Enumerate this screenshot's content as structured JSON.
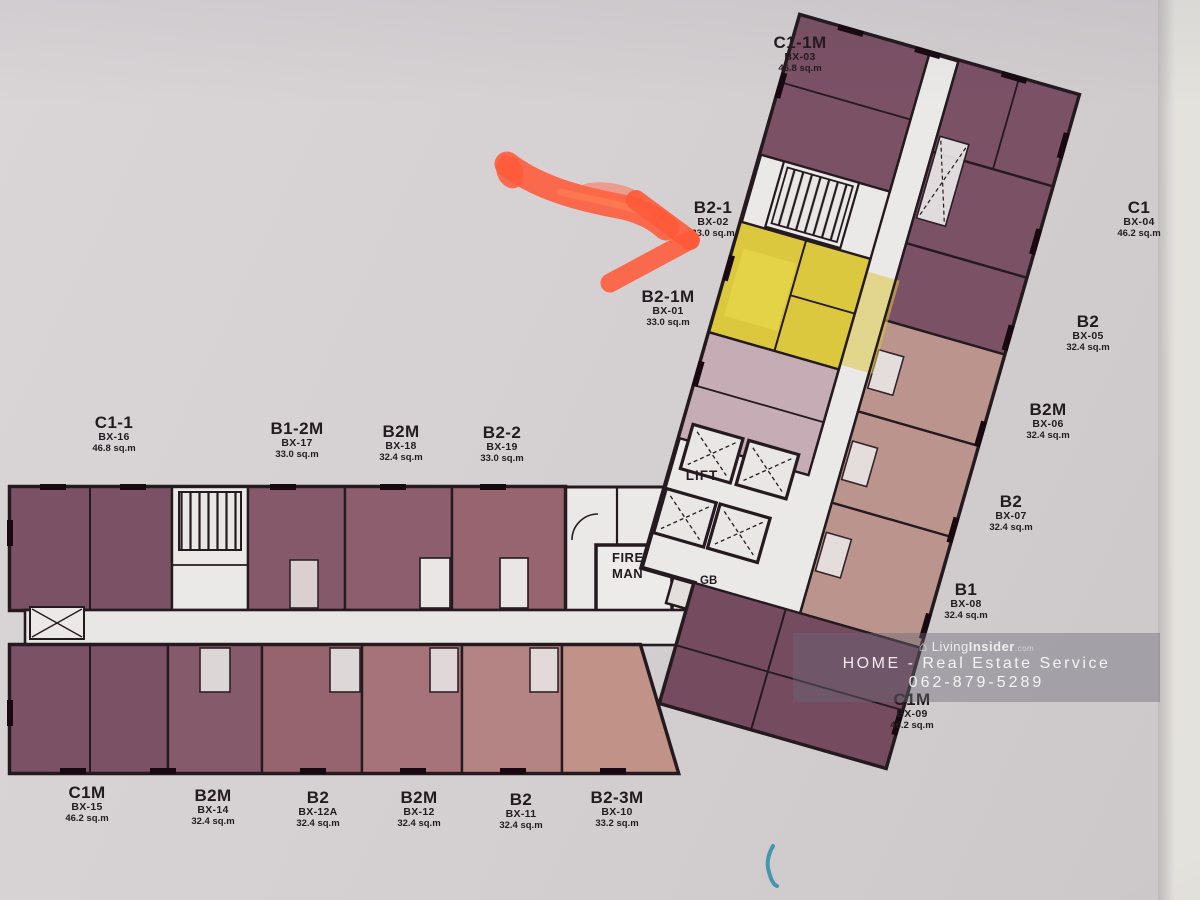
{
  "plan": {
    "units": [
      {
        "name": "C1-1M",
        "code": "BX-03",
        "area": "46.8 sq.m"
      },
      {
        "name": "B2-1",
        "code": "BX-02",
        "area": "33.0 sq.m"
      },
      {
        "name": "B2-1M",
        "code": "BX-01",
        "area": "33.0 sq.m"
      },
      {
        "name": "C1",
        "code": "BX-04",
        "area": "46.2 sq.m"
      },
      {
        "name": "B2",
        "code": "BX-05",
        "area": "32.4 sq.m"
      },
      {
        "name": "B2M",
        "code": "BX-06",
        "area": "32.4 sq.m"
      },
      {
        "name": "B2",
        "code": "BX-07",
        "area": "32.4 sq.m"
      },
      {
        "name": "B1",
        "code": "BX-08",
        "area": "32.4 sq.m"
      },
      {
        "name": "C1M",
        "code": "BX-09",
        "area": "46.2 sq.m"
      },
      {
        "name": "C1-1",
        "code": "BX-16",
        "area": "46.8 sq.m"
      },
      {
        "name": "B1-2M",
        "code": "BX-17",
        "area": "33.0 sq.m"
      },
      {
        "name": "B2M",
        "code": "BX-18",
        "area": "32.4 sq.m"
      },
      {
        "name": "B2-2",
        "code": "BX-19",
        "area": "33.0 sq.m"
      },
      {
        "name": "C1M",
        "code": "BX-15",
        "area": "46.2 sq.m"
      },
      {
        "name": "B2M",
        "code": "BX-14",
        "area": "32.4 sq.m"
      },
      {
        "name": "B2",
        "code": "BX-12A",
        "area": "32.4 sq.m"
      },
      {
        "name": "B2M",
        "code": "BX-12",
        "area": "32.4 sq.m"
      },
      {
        "name": "B2",
        "code": "BX-11",
        "area": "32.4 sq.m"
      },
      {
        "name": "B2-3M",
        "code": "BX-10",
        "area": "33.2 sq.m"
      }
    ],
    "core": {
      "lift": "LIFT",
      "fire_line1": "FIRE",
      "fire_line2": "MAN",
      "gb": "GB"
    },
    "highlighted_unit": "B2-1 (BX-02)"
  },
  "watermark": {
    "house_icon": "⌂",
    "brand": "Living",
    "brand_bold": "Insider",
    "brand_suffix": ".com",
    "line2": "HOME - Real Estate Service",
    "line3": "062-879-5289"
  },
  "colors": {
    "highlight_yellow": "#dcc83f",
    "arrow_orange": "#ff5a38",
    "unit_purple": "#7b5166",
    "unit_rose": "#bb948e",
    "unit_pale_mauve": "#c6acb4",
    "paper": "#d6d2d4",
    "wall": "#241a1f",
    "watermark_band": "#686775"
  }
}
